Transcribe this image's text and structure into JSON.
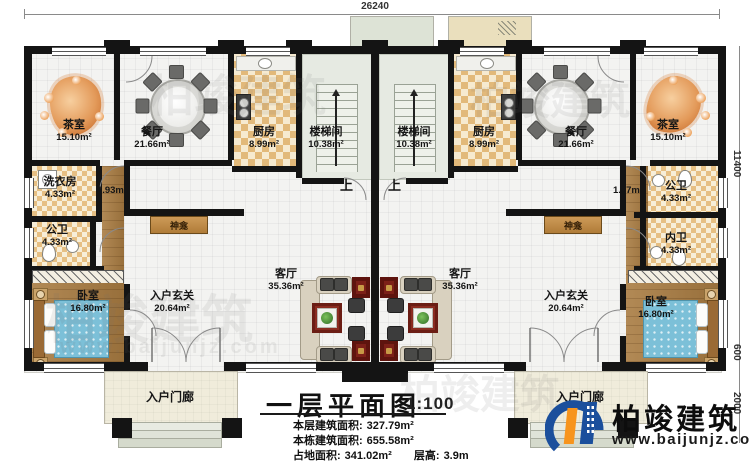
{
  "dimensions": {
    "top_width": "26240",
    "right_height": "11400",
    "right_mid": "600",
    "right_porch": "2000"
  },
  "stairs": {
    "up_left": "上",
    "up_right": "上"
  },
  "units": {
    "left": {
      "tea_room": {
        "name": "茶室",
        "area": "15.10m²"
      },
      "dining": {
        "name": "餐厅",
        "area": "21.66m²"
      },
      "kitchen": {
        "name": "厨房",
        "area": "8.99m²"
      },
      "stairwell": {
        "name": "楼梯间",
        "area": "10.38m²"
      },
      "laundry": {
        "name": "洗衣房",
        "area": "4.33m²"
      },
      "hall_area": "1.93m²",
      "public_bath": {
        "name": "公卫",
        "area": "4.33m²"
      },
      "bedroom": {
        "name": "卧室",
        "area": "16.80m²"
      },
      "foyer": {
        "name": "入户玄关",
        "area": "20.64m²"
      },
      "living": {
        "name": "客厅",
        "area": "35.36m²"
      },
      "shrine": "神龛",
      "porch": "入户门廊"
    },
    "right": {
      "tea_room": {
        "name": "茶室",
        "area": "15.10m²"
      },
      "dining": {
        "name": "餐厅",
        "area": "21.66m²"
      },
      "kitchen": {
        "name": "厨房",
        "area": "8.99m²"
      },
      "stairwell": {
        "name": "楼梯间",
        "area": "10.38m²"
      },
      "public_bath": {
        "name": "公卫",
        "area": "4.33m²"
      },
      "hall_area": "1.77m²",
      "inner_bath": {
        "name": "内卫",
        "area": "4.33m²"
      },
      "bedroom": {
        "name": "卧室",
        "area": "16.80m²"
      },
      "foyer": {
        "name": "入户玄关",
        "area": "20.64m²"
      },
      "living": {
        "name": "客厅",
        "area": "35.36m²"
      },
      "shrine": "神龛",
      "porch": "入户门廊"
    }
  },
  "title_block": {
    "title": "一层平面图",
    "scale": "1:100",
    "floor_area_label": "本层建筑面积:",
    "floor_area_value": "327.79m²",
    "building_area_label": "本栋建筑面积:",
    "building_area_value": "655.58m²",
    "footprint_label": "占地面积:",
    "footprint_value": "341.02m²",
    "height_label": "层高:",
    "height_value": "3.9m"
  },
  "brand": {
    "logo_text": "柏竣建筑",
    "website": "www.baijunjz.com"
  },
  "watermark": {
    "text": "柏竣建筑",
    "subtext": "www.baijunjz.com"
  }
}
